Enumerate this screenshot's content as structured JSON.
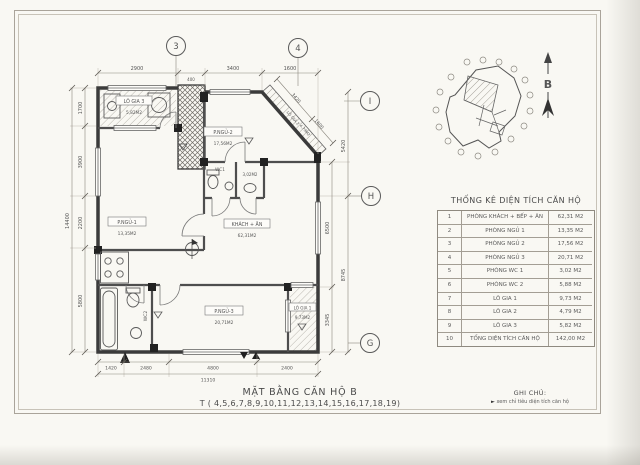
{
  "page": {
    "title": "MẶT BẰNG CĂN HỘ B",
    "subtitle": "T ( 4,5,6,7,8,9,10,11,12,13,14,15,16,17,18,19)"
  },
  "notes": {
    "heading": "GHI CHÚ:",
    "bullet": "►",
    "item": "xem chỉ tiêu diện tích căn hộ"
  },
  "north": {
    "label": "B"
  },
  "grid": {
    "top": [
      "3",
      "4"
    ],
    "right": [
      "I",
      "H",
      "G"
    ]
  },
  "dims": {
    "top": [
      "2900",
      "400",
      "3400",
      "1600"
    ],
    "diag": [
      "3420",
      "1600"
    ],
    "left": [
      "1700",
      "3900",
      "2200",
      "5800"
    ],
    "left_total": "14400",
    "bottom": [
      "1420",
      "2480",
      "4800",
      "2400"
    ],
    "bottom_total": "11310",
    "right_inner": [
      "6500",
      "3345"
    ],
    "right_outer": [
      "5420",
      "8745"
    ]
  },
  "rooms": {
    "logia3": {
      "name": "LÔ GIA 3",
      "area": "5,82M2"
    },
    "pngu1": {
      "name": "P.NGỦ-1",
      "area": "13,35M2"
    },
    "pngu2": {
      "name": "P.NGỦ-2",
      "area": "17,56M2"
    },
    "wc1": {
      "name": "WC1",
      "area": "3,02M2"
    },
    "wc2": {
      "name": "WC2",
      "area": "5,88M2"
    },
    "khach": {
      "name": "KHÁCH + ĂN",
      "area": "62,31M2"
    },
    "pngu3": {
      "name": "P.NGỦ-3",
      "area": "20,71M2"
    },
    "logia1": {
      "name": "LÔ GIA 1",
      "area": "9,73M2"
    },
    "logia2": {
      "name": "LÔ GIA 2",
      "area": "4,79M2"
    }
  },
  "table": {
    "title": "THỐNG KÊ DIỆN TÍCH CĂN HỘ",
    "rows": [
      {
        "no": "1",
        "name": "PHÒNG KHÁCH + BẾP + ĂN",
        "area": "62,31 M2"
      },
      {
        "no": "2",
        "name": "PHÒNG NGỦ 1",
        "area": "13,35 M2"
      },
      {
        "no": "3",
        "name": "PHÒNG NGỦ 2",
        "area": "17,56 M2"
      },
      {
        "no": "4",
        "name": "PHÒNG NGỦ 3",
        "area": "20,71 M2"
      },
      {
        "no": "5",
        "name": "PHÒNG WC 1",
        "area": "3,02 M2"
      },
      {
        "no": "6",
        "name": "PHÒNG WC 2",
        "area": "5,88 M2"
      },
      {
        "no": "7",
        "name": "LÔ GIA 1",
        "area": "9,73 M2"
      },
      {
        "no": "8",
        "name": "LÔ GIA 2",
        "area": "4,79 M2"
      },
      {
        "no": "9",
        "name": "LÔ GIA 3",
        "area": "5,82 M2"
      },
      {
        "no": "10",
        "name": "TỔNG DIỆN TÍCH CĂN HỘ",
        "area": "142,00 M2"
      }
    ]
  },
  "colors": {
    "line": "#4a4a4a",
    "paper": "#f9f8f3"
  }
}
